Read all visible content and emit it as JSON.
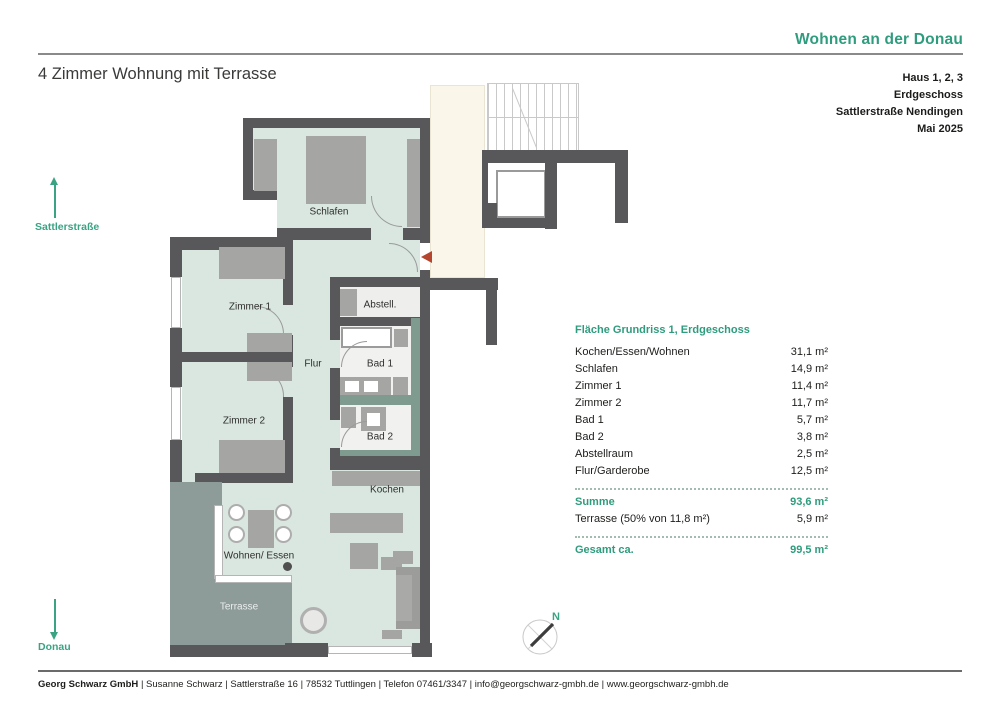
{
  "header": {
    "brand": "Wohnen an der Donau",
    "title": "4 Zimmer Wohnung mit Terrasse",
    "info_lines": [
      "Haus 1, 2, 3",
      "Erdgeschoss",
      "Sattlerstraße Nendingen",
      "Mai 2025"
    ]
  },
  "orientation": {
    "street": "Sattlerstraße",
    "river": "Donau",
    "compass_north": "N"
  },
  "plan": {
    "labels": {
      "schlafen": "Schlafen",
      "zimmer1": "Zimmer 1",
      "zimmer2": "Zimmer 2",
      "flur": "Flur",
      "abstell": "Abstell.",
      "bad1": "Bad 1",
      "bad2": "Bad 2",
      "kochen": "Kochen",
      "wohnen_essen": "Wohnen/ Essen",
      "terrasse": "Terrasse"
    }
  },
  "area_table": {
    "title": "Fläche Grundriss 1, Erdgeschoss",
    "rows": [
      {
        "label": "Kochen/Essen/Wohnen",
        "value": "31,1 m²"
      },
      {
        "label": "Schlafen",
        "value": "14,9 m²"
      },
      {
        "label": "Zimmer 1",
        "value": "11,4 m²"
      },
      {
        "label": "Zimmer 2",
        "value": "11,7 m²"
      },
      {
        "label": "Bad 1",
        "value": "5,7 m²"
      },
      {
        "label": "Bad 2",
        "value": "3,8 m²"
      },
      {
        "label": "Abstellraum",
        "value": "2,5 m²"
      },
      {
        "label": "Flur/Garderobe",
        "value": "12,5 m²"
      }
    ],
    "summe": {
      "label": "Summe",
      "value": "93,6 m²"
    },
    "terrasse_row": {
      "label": "Terrasse (50% von 11,8 m²)",
      "value": "5,9 m²"
    },
    "gesamt": {
      "label": "Gesamt ca.",
      "value": "99,5 m²"
    }
  },
  "footer": {
    "company": "Georg Schwarz GmbH",
    "details": "| Susanne Schwarz | Sattlerstraße 16 | 78532 Tuttlingen | Telefon 07461/3347 | info@georgschwarz-gmbh.de | www.georgschwarz-gmbh.de"
  },
  "colors": {
    "accent": "#2f9c7d",
    "wall": "#58585a",
    "floor": "#d9e7e0",
    "bath_floor": "#f1f1ef",
    "bath_wall": "#7f9b90",
    "terrace": "#8d9c99",
    "stairwell": "#faf6e9",
    "furniture": "#a5a6a4",
    "entrance_arrow": "#b5452e"
  }
}
